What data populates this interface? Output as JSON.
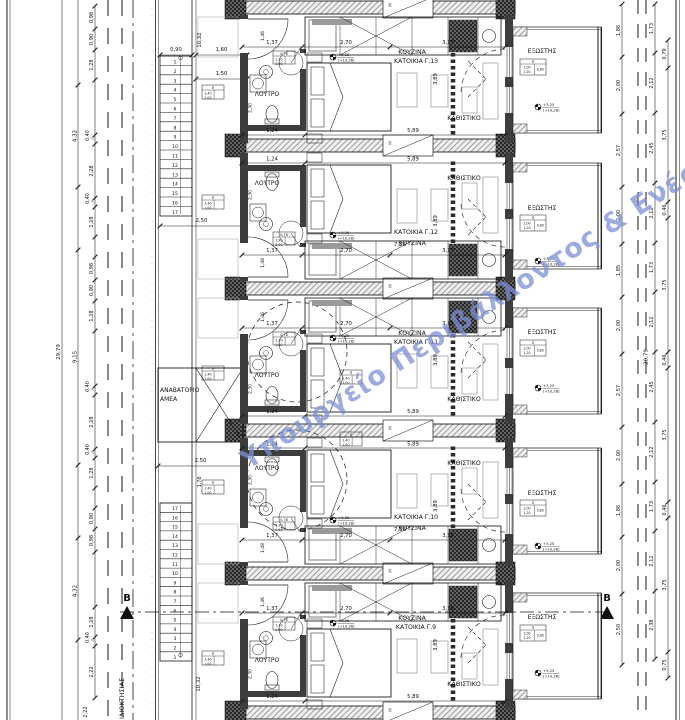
{
  "watermark": {
    "text": "Υπουργείο Περιβάλλοντος & Ενέρ",
    "color": "#7b8fd6"
  },
  "boundary_label": "ΙΔΙΟΚΤΗΣΙΑΣ",
  "section": {
    "label": "B"
  },
  "lift": {
    "label_line1": "ΑΝΑΒΑΤΟΡΙΟ",
    "label_line2": "ΑΜΕΑ"
  },
  "levels": {
    "relative": "+3,25",
    "absolute": "(+10,28)"
  },
  "band_label": "Π",
  "stairs": {
    "top_numbers": [
      "1",
      "2",
      "3",
      "4",
      "5",
      "6",
      "7",
      "8",
      "9",
      "10",
      "11",
      "12",
      "13",
      "14",
      "15",
      "16",
      "17"
    ],
    "bottom_numbers": [
      "17",
      "16",
      "15",
      "14",
      "13",
      "12",
      "11",
      "10",
      "9",
      "8",
      "7",
      "6",
      "5",
      "4",
      "3",
      "2",
      "1"
    ],
    "run_dim": "10,32",
    "width_dim": "0,90",
    "top_dims": [
      "1,60",
      "1,50"
    ],
    "landing_dim": "2,50",
    "lift_dim": "2,50",
    "lift_side_dim": "1,78",
    "bottom_total": "2,22"
  },
  "left_dims": {
    "overall": "29,79",
    "mid_total": "9,15",
    "sub_total_top": "4,32",
    "sub_total_bottom": "4,32",
    "chain": [
      "0,98",
      "0,90",
      "1,28",
      "",
      "0,40",
      "2,28",
      "0,40",
      "1,28",
      "",
      "0,98",
      "0,90",
      "1,28",
      "",
      "0,40",
      "2,28",
      "0,40",
      "1,28",
      "",
      "0,90",
      "0,98",
      "",
      "1,28",
      "0,40",
      "2,22"
    ]
  },
  "right_dims": {
    "overall": "29,79",
    "chain_inner": [
      "1,86",
      "2,00",
      "2,57",
      "2,00",
      "1,85",
      "2,00",
      "2,57",
      "2,00",
      "1,86",
      "2,00",
      "2,50"
    ],
    "chain_mid": [
      "1,73",
      "2,12",
      "2,45",
      "2,12",
      "1,73",
      "2,12",
      "2,45",
      "2,12",
      "1,73",
      "2,12",
      "2,38"
    ],
    "chain_outer": [
      "0,79",
      "3,75",
      "0,46",
      "3,75",
      "0,46",
      "3,75",
      "0,46",
      "3,75",
      "0,75"
    ]
  },
  "units": [
    {
      "name": "ΚΑΤΟΙΚΙΑ Γ.13",
      "kitchen": "ΚΟΥΖΙΝΑ",
      "bath": "ΛΟΥΤΡΟ",
      "living": "ΚΑΘΙΣΤΙΚΟ",
      "balcony": "ΕΞΩΣΤΗΣ",
      "mirrored": false,
      "top_dims": [
        "1,37",
        "2,70",
        "3,19"
      ],
      "bed_dim": "3,89",
      "bath_w_dim": "1,24",
      "living_w_dim": "5,89",
      "entry_dim": "1,46",
      "bath_h_dim": "2,30",
      "pair_total": ""
    },
    {
      "name": "ΚΑΤΟΙΚΙΑ Γ.12",
      "kitchen": "ΚΟΥΖΙΝΑ",
      "bath": "ΛΟΥΤΡΟ",
      "living": "ΚΑΘΙΣΤΙΚΟ",
      "balcony": "ΕΞΩΣΤΗΣ",
      "mirrored": true,
      "top_dims": [
        "1,37",
        "2,70",
        "3,19"
      ],
      "bed_dim": "3,89",
      "bath_w_dim": "1,24",
      "living_w_dim": "5,89",
      "entry_dim": "1,48",
      "bath_h_dim": "2,30",
      "pair_total": "7,26"
    },
    {
      "name": "ΚΑΤΟΙΚΙΑ Γ.11",
      "kitchen": "ΚΟΥΖΙΝΑ",
      "bath": "ΛΟΥΤΡΟ",
      "living": "ΚΑΘΙΣΤΙΚΟ",
      "balcony": "ΕΞΩΣΤΗΣ",
      "mirrored": false,
      "top_dims": [
        "1,37",
        "2,70",
        "3,19"
      ],
      "bed_dim": "3,89",
      "bath_w_dim": "1,24",
      "living_w_dim": "5,89",
      "entry_dim": "1,46",
      "bath_h_dim": "2,30",
      "pair_total": ""
    },
    {
      "name": "ΚΑΤΟΙΚΙΑ Γ.10",
      "kitchen": "ΚΟΥΖΙΝΑ",
      "bath": "ΛΟΥΤΡΟ",
      "living": "ΚΑΘΙΣΤΙΚΟ",
      "balcony": "ΕΞΩΣΤΗΣ",
      "mirrored": true,
      "top_dims": [
        "1,37",
        "2,70",
        "3,19"
      ],
      "bed_dim": "3,89",
      "bath_w_dim": "1,24",
      "living_w_dim": "5,89",
      "entry_dim": "1,48",
      "bath_h_dim": "2,30",
      "pair_total": "7,26"
    },
    {
      "name": "ΚΑΤΟΙΚΙΑ Γ.9",
      "kitchen": "ΚΟΥΖΙΝΑ",
      "bath": "ΛΟΥΤΡΟ",
      "living": "ΚΑΘΙΣΤΙΚΟ",
      "balcony": "ΕΞΩΣΤΗΣ",
      "mirrored": false,
      "top_dims": [
        "1,37",
        "2,70",
        "3,19"
      ],
      "bed_dim": "3,89",
      "bath_w_dim": "1,24",
      "living_w_dim": "5,89",
      "entry_dim": "1,46",
      "bath_h_dim": "2,30",
      "pair_total": ""
    }
  ],
  "tables": {
    "balcony": [
      "Π",
      "2,00",
      "1,20",
      "0,80"
    ],
    "entry": [
      "Π",
      "1,40",
      "1,00"
    ],
    "bath": [
      "0,78",
      "1,30",
      "0,90"
    ]
  }
}
